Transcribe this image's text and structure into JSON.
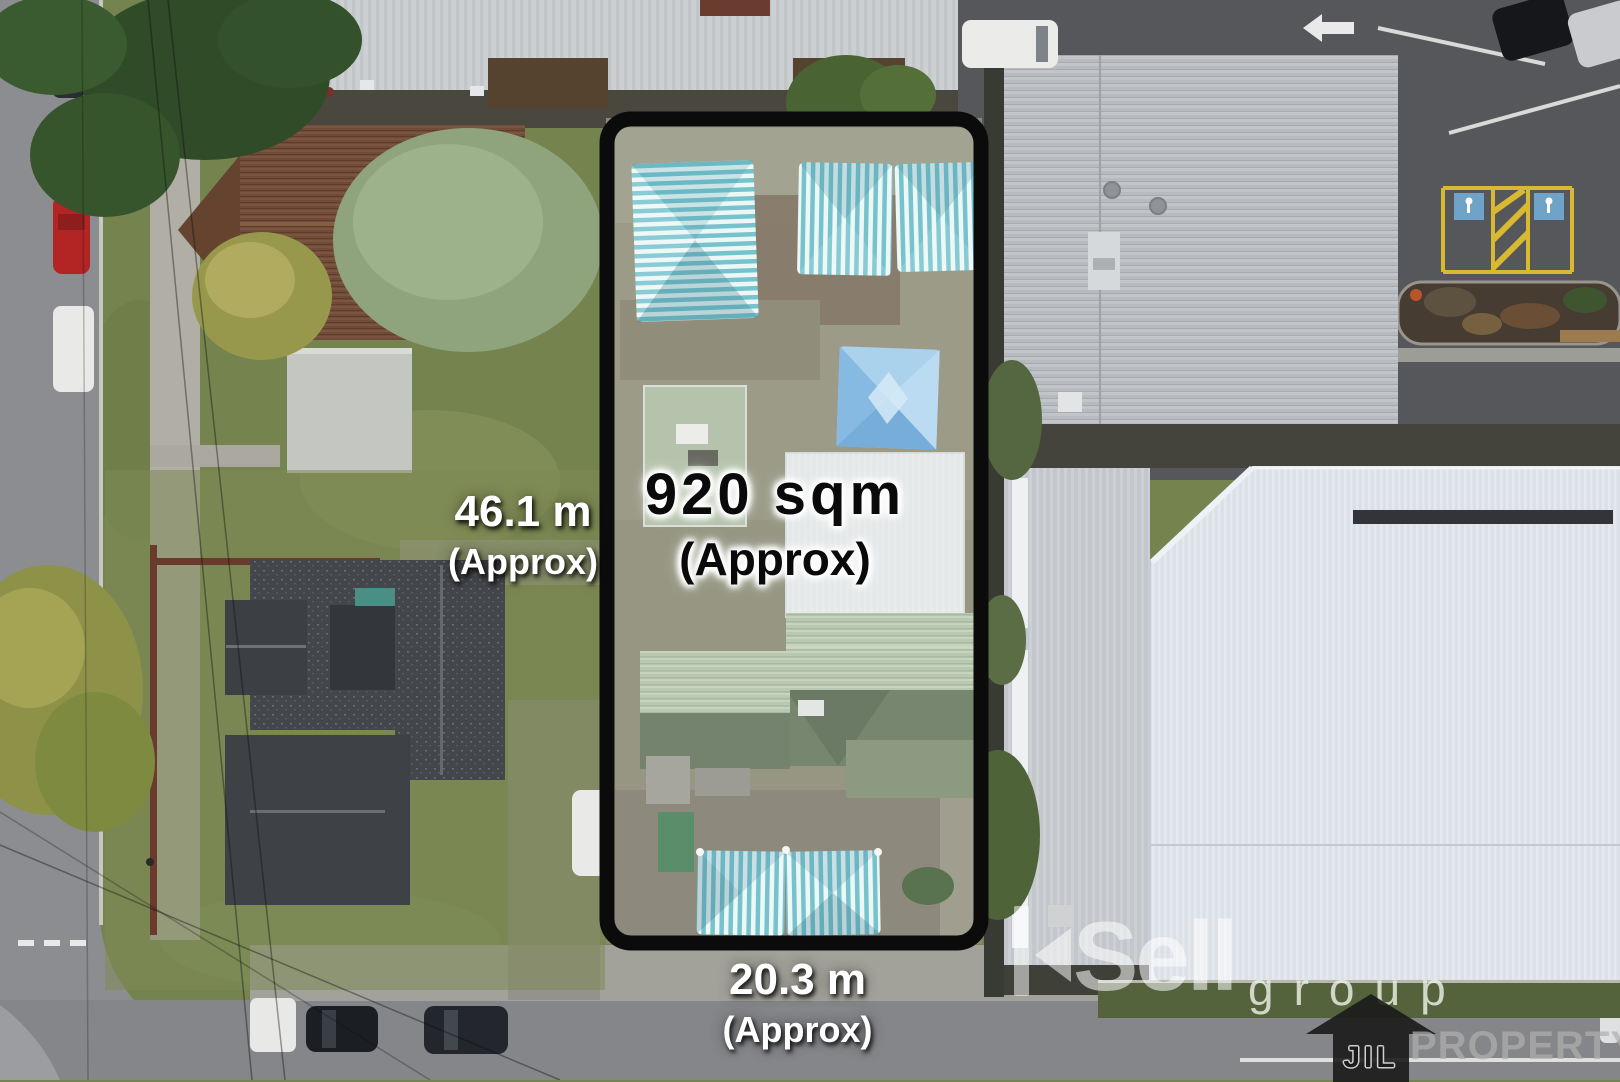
{
  "annotations": {
    "area_value": "920 sqm",
    "area_qualifier": "(Approx)",
    "side_value": "46.1 m",
    "side_qualifier": "(Approx)",
    "frontage_value": "20.3 m",
    "frontage_qualifier": "(Approx)"
  },
  "watermark": {
    "brand_rest": "Sell",
    "group": "group"
  },
  "logo": {
    "initials": "JIL",
    "name": "PROPERTY"
  },
  "colors": {
    "boundary": "#0b0b0b",
    "area_text": "#0a0a0a",
    "dimension_text": "#ffffff",
    "sail_teal": "#5fb9c6",
    "sail_blue": "#9ccae9",
    "disabled_bay_yellow": "#d9b832"
  }
}
